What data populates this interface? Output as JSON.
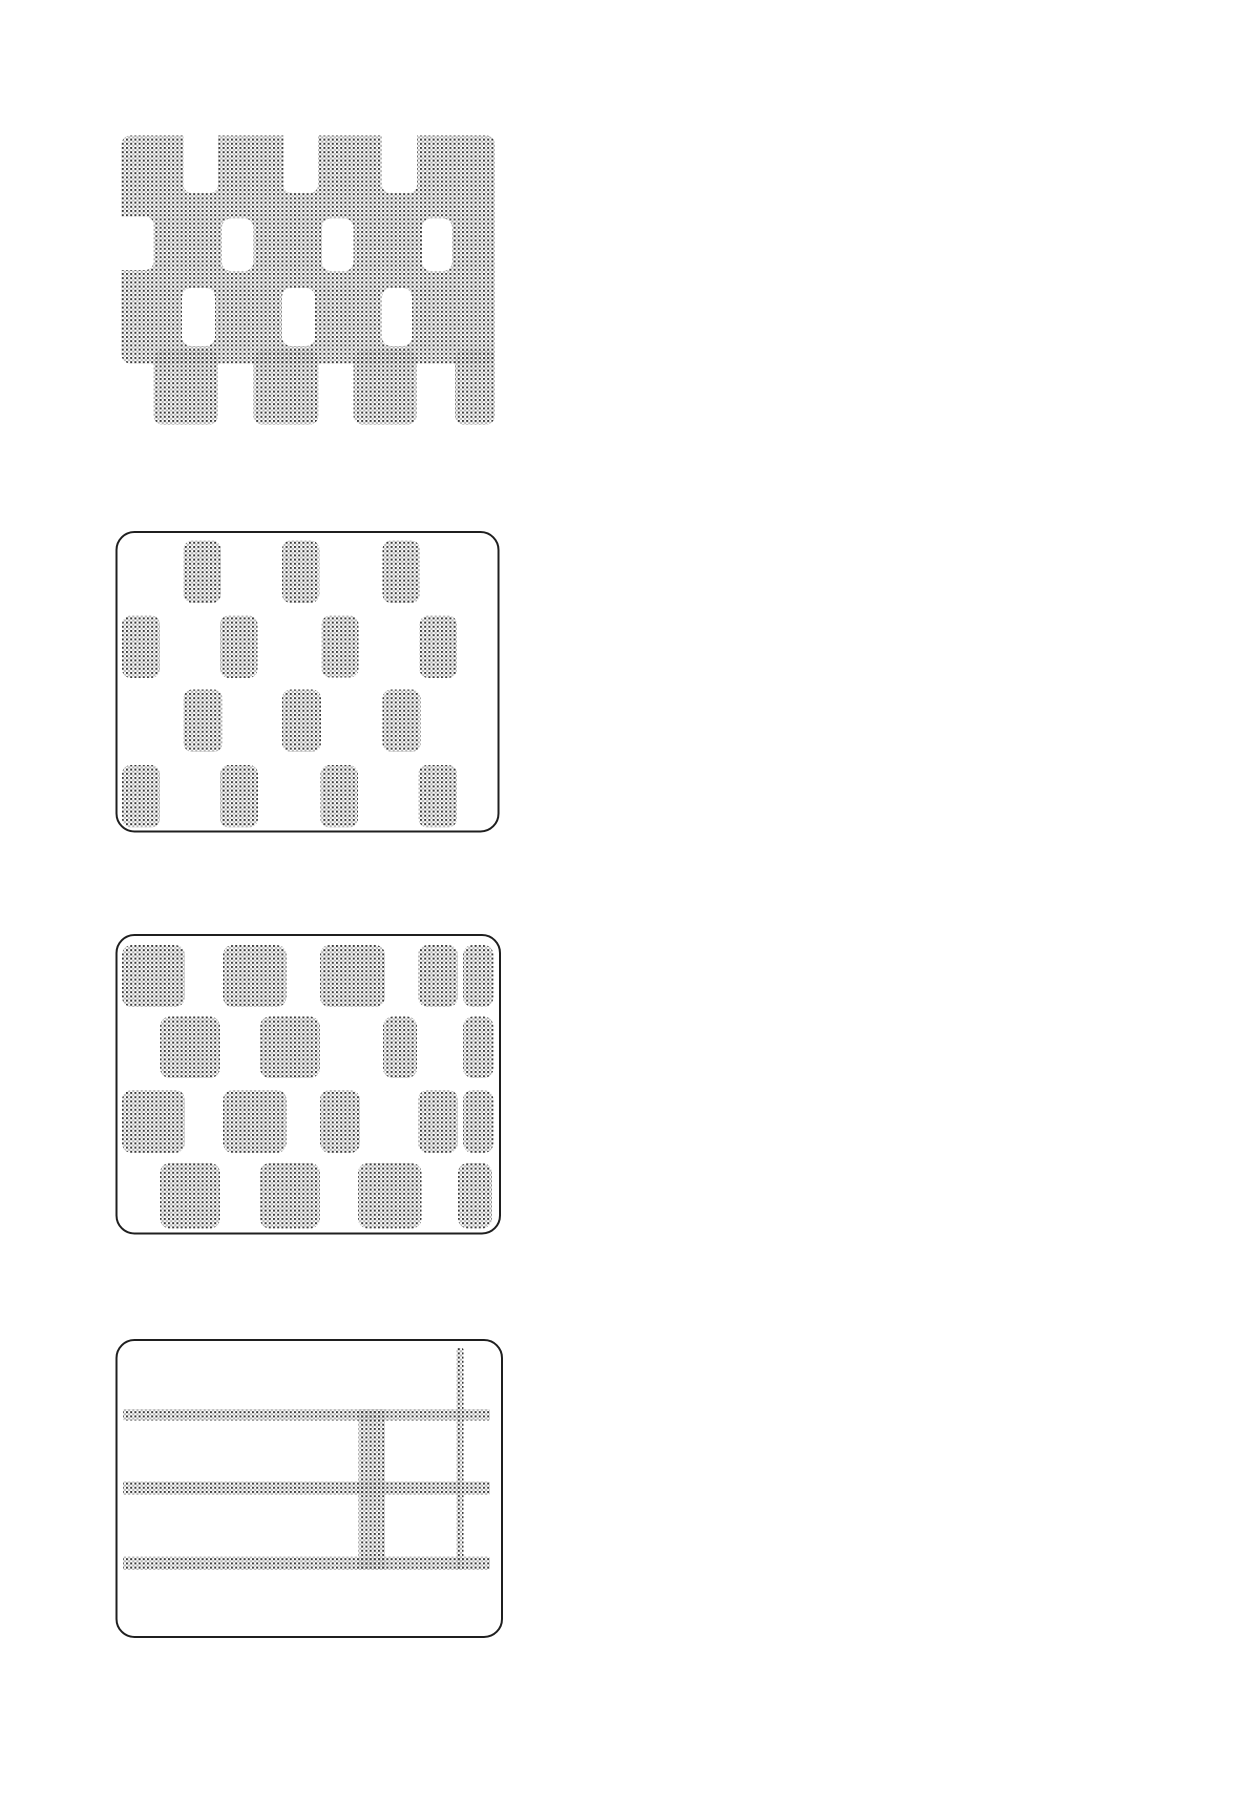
{
  "page": {
    "width": 1260,
    "height": 1800,
    "background": "#ffffff"
  },
  "palette": {
    "dot_dark": "#383838",
    "dot_light": "#b2b2b2",
    "border": "#1f1f1f",
    "cutout_fill": "#ffffff",
    "box_fill": "#ffffff"
  },
  "halftone": {
    "cell": 4.2,
    "dot": 2.0
  },
  "border_width": 2,
  "figures": [
    {
      "name": "figure-1-perforated-halftone-sheet",
      "bbox": {
        "x": 110,
        "y": 124,
        "w": 396,
        "h": 306
      },
      "box": null,
      "shapes": [
        {
          "kind": "dot",
          "x": 121.5,
          "y": 135.5,
          "w": 373.5,
          "h": 228,
          "rx": 9
        },
        {
          "kind": "dot",
          "x": 153.5,
          "y": 350,
          "w": 64.5,
          "h": 74.5,
          "rx": 9
        },
        {
          "kind": "dot",
          "x": 253.5,
          "y": 350,
          "w": 65,
          "h": 74.5,
          "rx": 9
        },
        {
          "kind": "dot",
          "x": 353.5,
          "y": 350,
          "w": 63,
          "h": 74.5,
          "rx": 9
        },
        {
          "kind": "dot",
          "x": 455,
          "y": 350,
          "w": 40,
          "h": 74.5,
          "rx": 9
        },
        {
          "kind": "white",
          "x": 183.5,
          "y": 126,
          "w": 34.5,
          "h": 67,
          "rx": 8
        },
        {
          "kind": "white",
          "x": 283.5,
          "y": 126,
          "w": 34.5,
          "h": 67,
          "rx": 8
        },
        {
          "kind": "white",
          "x": 382,
          "y": 126,
          "w": 35,
          "h": 67,
          "rx": 8
        },
        {
          "kind": "white",
          "x": 110,
          "y": 216.5,
          "w": 43.5,
          "h": 53.5,
          "rx": 8
        },
        {
          "kind": "white",
          "x": 222,
          "y": 218.5,
          "w": 31.5,
          "h": 52.5,
          "rx": 9
        },
        {
          "kind": "white",
          "x": 322,
          "y": 218.5,
          "w": 31.5,
          "h": 52.5,
          "rx": 9
        },
        {
          "kind": "white",
          "x": 422,
          "y": 218.5,
          "w": 30,
          "h": 52.5,
          "rx": 9
        },
        {
          "kind": "white",
          "x": 182,
          "y": 288,
          "w": 33,
          "h": 58,
          "rx": 9
        },
        {
          "kind": "white",
          "x": 282,
          "y": 288,
          "w": 33,
          "h": 58,
          "rx": 9
        },
        {
          "kind": "white",
          "x": 382,
          "y": 288,
          "w": 30,
          "h": 58,
          "rx": 9
        }
      ]
    },
    {
      "name": "figure-2-dotted-rectangles-swatch",
      "bbox": {
        "x": 112,
        "y": 527,
        "w": 392,
        "h": 310
      },
      "box": {
        "x": 116.5,
        "y": 532,
        "w": 382,
        "h": 299.5,
        "rx": 18
      },
      "shapes": [
        {
          "kind": "dot",
          "x": 183.5,
          "y": 540.5,
          "w": 37.5,
          "h": 62.5,
          "rx": 9
        },
        {
          "kind": "dot",
          "x": 282,
          "y": 540.5,
          "w": 37.5,
          "h": 62.5,
          "rx": 9
        },
        {
          "kind": "dot",
          "x": 382.5,
          "y": 540.5,
          "w": 37.5,
          "h": 62.5,
          "rx": 9
        },
        {
          "kind": "dot",
          "x": 122,
          "y": 615.5,
          "w": 38,
          "h": 62.5,
          "rx": 9
        },
        {
          "kind": "dot",
          "x": 220,
          "y": 615.5,
          "w": 37.5,
          "h": 62.5,
          "rx": 9
        },
        {
          "kind": "dot",
          "x": 321.5,
          "y": 615.5,
          "w": 37,
          "h": 62,
          "rx": 9
        },
        {
          "kind": "dot",
          "x": 419.5,
          "y": 615.5,
          "w": 37.5,
          "h": 62.5,
          "rx": 9
        },
        {
          "kind": "dot",
          "x": 183.5,
          "y": 689.5,
          "w": 39,
          "h": 62.5,
          "rx": 9
        },
        {
          "kind": "dot",
          "x": 282,
          "y": 689.5,
          "w": 39,
          "h": 62.5,
          "rx": 9
        },
        {
          "kind": "dot",
          "x": 382.5,
          "y": 689.5,
          "w": 38,
          "h": 62.5,
          "rx": 9
        },
        {
          "kind": "dot",
          "x": 122,
          "y": 765,
          "w": 38,
          "h": 62.5,
          "rx": 9
        },
        {
          "kind": "dot",
          "x": 220,
          "y": 765,
          "w": 38,
          "h": 62.5,
          "rx": 9
        },
        {
          "kind": "dot",
          "x": 320.5,
          "y": 765,
          "w": 37.5,
          "h": 62.5,
          "rx": 9
        },
        {
          "kind": "dot",
          "x": 418.5,
          "y": 765,
          "w": 38.5,
          "h": 62.5,
          "rx": 9
        }
      ]
    },
    {
      "name": "figure-3-dotted-squares-swatch",
      "bbox": {
        "x": 112,
        "y": 930,
        "w": 393,
        "h": 309
      },
      "box": {
        "x": 116.5,
        "y": 935,
        "w": 383.5,
        "h": 298.5,
        "rx": 18
      },
      "shapes": [
        {
          "kind": "dot",
          "x": 122,
          "y": 945,
          "w": 63,
          "h": 62,
          "rx": 10
        },
        {
          "kind": "dot",
          "x": 223,
          "y": 945,
          "w": 63.5,
          "h": 62,
          "rx": 10
        },
        {
          "kind": "dot",
          "x": 320,
          "y": 945,
          "w": 65,
          "h": 62,
          "rx": 10
        },
        {
          "kind": "dot",
          "x": 418,
          "y": 945,
          "w": 40,
          "h": 62,
          "rx": 10
        },
        {
          "kind": "dot",
          "x": 463,
          "y": 945,
          "w": 30.5,
          "h": 62,
          "rx": 10
        },
        {
          "kind": "dot",
          "x": 160,
          "y": 1016.5,
          "w": 60,
          "h": 61.5,
          "rx": 10
        },
        {
          "kind": "dot",
          "x": 260,
          "y": 1016.5,
          "w": 60,
          "h": 61.5,
          "rx": 10
        },
        {
          "kind": "dot",
          "x": 383,
          "y": 1016.5,
          "w": 34,
          "h": 61.5,
          "rx": 10
        },
        {
          "kind": "dot",
          "x": 463,
          "y": 1016.5,
          "w": 30.5,
          "h": 61.5,
          "rx": 10
        },
        {
          "kind": "dot",
          "x": 122,
          "y": 1090,
          "w": 63,
          "h": 63,
          "rx": 10
        },
        {
          "kind": "dot",
          "x": 223,
          "y": 1090,
          "w": 63.5,
          "h": 63,
          "rx": 10
        },
        {
          "kind": "dot",
          "x": 320,
          "y": 1090,
          "w": 40,
          "h": 63,
          "rx": 10
        },
        {
          "kind": "dot",
          "x": 418,
          "y": 1090,
          "w": 40,
          "h": 63,
          "rx": 10
        },
        {
          "kind": "dot",
          "x": 463,
          "y": 1090,
          "w": 30.5,
          "h": 63,
          "rx": 10
        },
        {
          "kind": "dot",
          "x": 160,
          "y": 1163,
          "w": 60,
          "h": 65.5,
          "rx": 10
        },
        {
          "kind": "dot",
          "x": 260,
          "y": 1163,
          "w": 60,
          "h": 65.5,
          "rx": 10
        },
        {
          "kind": "dot",
          "x": 358,
          "y": 1163,
          "w": 63.5,
          "h": 65.5,
          "rx": 10
        },
        {
          "kind": "dot",
          "x": 458,
          "y": 1163,
          "w": 34,
          "h": 65.5,
          "rx": 10
        }
      ]
    },
    {
      "name": "figure-4-dotted-grid-swatch",
      "bbox": {
        "x": 112,
        "y": 1335,
        "w": 395,
        "h": 307
      },
      "box": {
        "x": 116.5,
        "y": 1340,
        "w": 385.5,
        "h": 297,
        "rx": 18
      },
      "shapes": [
        {
          "kind": "dot",
          "x": 123,
          "y": 1409,
          "w": 367,
          "h": 11.5,
          "rx": 2
        },
        {
          "kind": "dot",
          "x": 123,
          "y": 1481.5,
          "w": 367,
          "h": 13.5,
          "rx": 2
        },
        {
          "kind": "dot",
          "x": 123,
          "y": 1556.5,
          "w": 367,
          "h": 13.5,
          "rx": 2
        },
        {
          "kind": "dot",
          "x": 358.5,
          "y": 1409,
          "w": 26.5,
          "h": 161,
          "rx": 2
        },
        {
          "kind": "dot",
          "x": 456.5,
          "y": 1348,
          "w": 7,
          "h": 222,
          "rx": 2
        }
      ]
    }
  ]
}
